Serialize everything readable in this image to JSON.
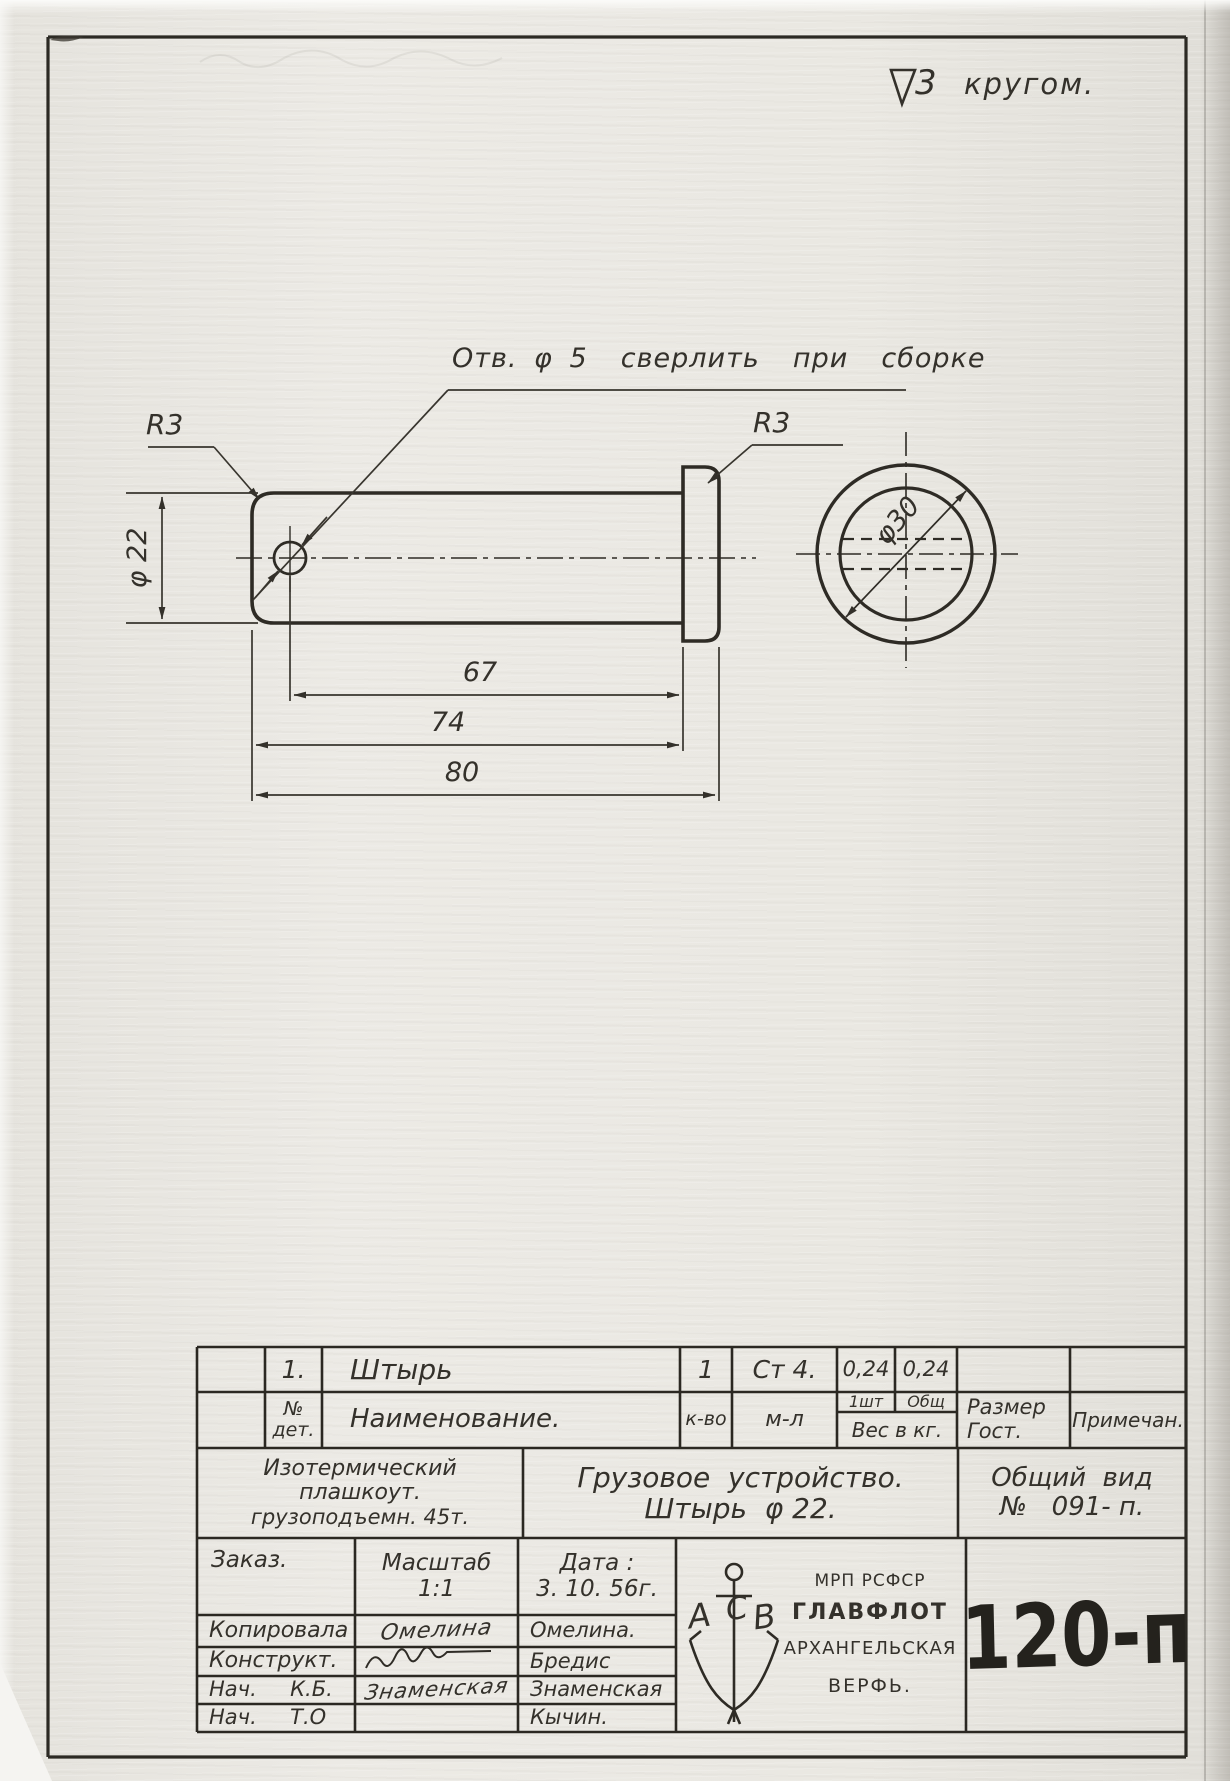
{
  "finish_mark": {
    "grade": "3",
    "scope": "кругом."
  },
  "drawing": {
    "hole_note": "Отв. φ 5  сверлить  при  сборке",
    "radius_left": "R3",
    "radius_right": "R3",
    "dia_body": "φ 22",
    "dia_head": "φ30",
    "dim_to_hole": "67",
    "dim_body": "74",
    "dim_total": "80"
  },
  "parts_table": {
    "row": {
      "no": "1.",
      "name": "Штырь",
      "qty": "1",
      "material": "Ст 4.",
      "weight_each": "0,24",
      "weight_total": "0,24"
    },
    "headers": {
      "no_l1": "№",
      "no_l2": "дет.",
      "name": "Наименование.",
      "qty": "к-во",
      "material": "м-л",
      "per_item": "1шт",
      "overall": "Общ",
      "weight": "Вес в кг.",
      "size_l1": "Размер",
      "size_l2": "Гост.",
      "note": "Примечан."
    }
  },
  "title_block": {
    "object_l1": "Изотермический",
    "object_l2": "плашкоут.",
    "object_l3": "грузоподъемн. 45т.",
    "title_l1": "Грузовое  устройство.",
    "title_l2": "Штырь  φ 22.",
    "view_l1": "Общий  вид",
    "view_l2": "№   091- п.",
    "order_label": "Заказ.",
    "scale_label": "Масштаб",
    "scale_value": "1:1",
    "date_label": "Дата :",
    "date_value": "3. 10. 56г.",
    "sign_rows": [
      {
        "role": "Копировала",
        "sig": "Омелина",
        "name": "Омелина."
      },
      {
        "role": "Конструкт.",
        "sig": "",
        "name": "Бредис"
      },
      {
        "role": "Нач.     К.Б.",
        "sig": "Знаменская",
        "name": "Знаменская"
      },
      {
        "role": "Нач.     Т.О",
        "sig": "",
        "name": "Кычин."
      }
    ],
    "org": {
      "letters": [
        "А",
        "С",
        "В"
      ],
      "l1": "МРП РСФСР",
      "l2": "ГЛАВФЛОТ",
      "l3": "АРХАНГЕЛЬСКАЯ",
      "l4": "ВЕРФЬ."
    },
    "doc_no": "120-п"
  }
}
